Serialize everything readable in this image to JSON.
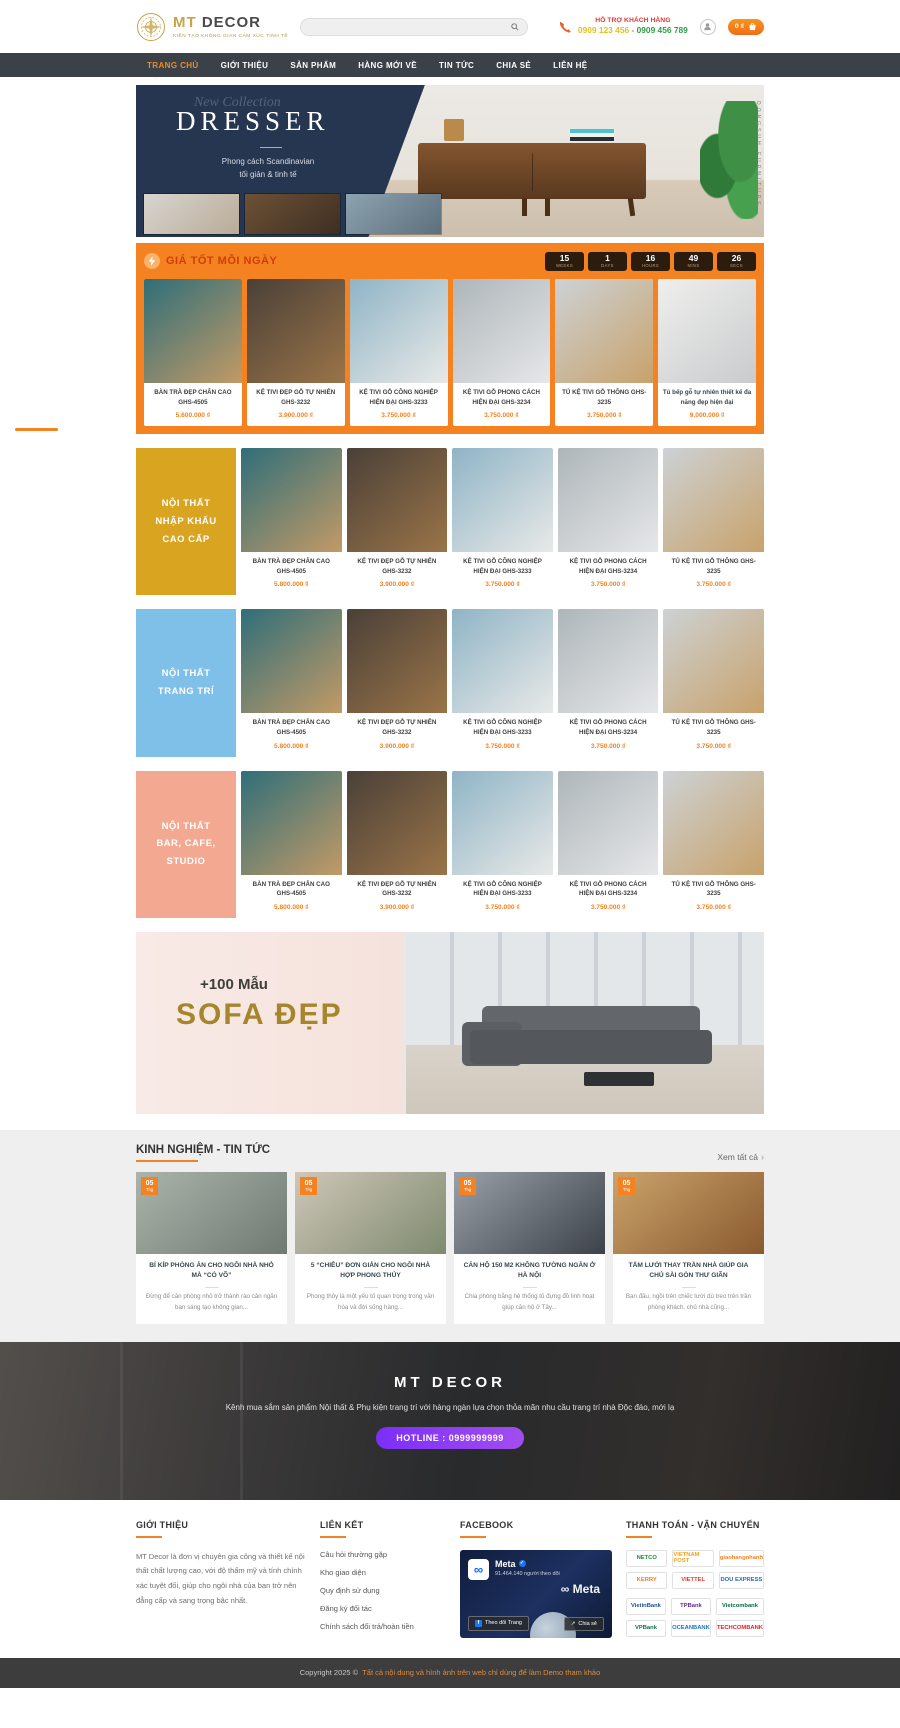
{
  "header": {
    "logo": {
      "brand_mt": "MT",
      "brand_decor": "DECOR",
      "tagline": "KIẾN TẠO KHÔNG GIAN CẢM XÚC TINH TẾ"
    },
    "search": {
      "placeholder": ""
    },
    "support": {
      "label": "HỖ TRỢ KHÁCH HÀNG",
      "phone1": "0909 123 456",
      "separator": "-",
      "phone2": "0909 456 789"
    },
    "cart": {
      "amount": "0 ₫"
    }
  },
  "nav": {
    "items": [
      {
        "label": "TRANG CHỦ",
        "active": true
      },
      {
        "label": "GIỚI THIỆU"
      },
      {
        "label": "SẢN PHẨM"
      },
      {
        "label": "HÀNG MỚI VỀ"
      },
      {
        "label": "TIN TỨC"
      },
      {
        "label": "CHIA SẺ"
      },
      {
        "label": "LIÊN HỆ"
      }
    ]
  },
  "hero": {
    "collection": "New Collection",
    "title": "DRESSER",
    "subtitle1": "Phong cách Scandinavian",
    "subtitle2": "tối giản & tinh tế",
    "vertical_text": "DONGSUH FURNITURE",
    "thumbs": [
      {
        "img": [
          "#d8d5d0",
          "#b9ab97"
        ]
      },
      {
        "img": [
          "#6d5136",
          "#3e2f22"
        ]
      },
      {
        "img": [
          "#8da3b0",
          "#5d6f7c"
        ]
      }
    ]
  },
  "deal": {
    "title": "GIÁ TỐT MỖI NGÀY",
    "countdown": [
      {
        "value": "15",
        "label": "WEEKS"
      },
      {
        "value": "1",
        "label": "DAYS"
      },
      {
        "value": "16",
        "label": "HOURS"
      },
      {
        "value": "49",
        "label": "MINS"
      },
      {
        "value": "26",
        "label": "SECS"
      }
    ],
    "products": [
      {
        "name": "BÀN TRÀ ĐẸP CHÂN CAO GHS-4505",
        "price": "5.600.000 ₫",
        "img": [
          "#2f6e79",
          "#c29a66"
        ]
      },
      {
        "name": "KỆ TIVI ĐẸP GỖ TỰ NHIÊN GHS-3232",
        "price": "3.900.000 ₫",
        "img": [
          "#4a4038",
          "#9a7448"
        ]
      },
      {
        "name": "KỆ TIVI GỖ CÔNG NGHIỆP HIỆN ĐẠI GHS-3233",
        "price": "3.750.000 ₫",
        "img": [
          "#8fb4c6",
          "#e8e9e7"
        ]
      },
      {
        "name": "KỆ TIVI GỖ PHONG CÁCH HIỆN ĐẠI GHS-3234",
        "price": "3.750.000 ₫",
        "img": [
          "#aeb6ba",
          "#e6e7e9"
        ]
      },
      {
        "name": "TỦ KỆ TIVI GỖ THÔNG GHS-3235",
        "price": "3.750.000 ₫",
        "img": [
          "#cdd2d5",
          "#c8a26b"
        ]
      },
      {
        "name": "Tủ bếp gỗ tự nhiên thiết kế đa năng đẹp hiện đại",
        "price": "9.000.000 ₫",
        "img": [
          "#efefed",
          "#c9cbcd"
        ],
        "plain": true
      }
    ]
  },
  "catalog": [
    {
      "name": "BÀN TRÀ ĐẸP CHÂN CAO GHS-4505",
      "price": "5.800.000 ₫",
      "img": [
        "#2f6e79",
        "#c29a66"
      ]
    },
    {
      "name": "KỆ TIVI ĐẸP GỖ TỰ NHIÊN GHS-3232",
      "price": "3.900.000 ₫",
      "img": [
        "#4a4038",
        "#9a7448"
      ]
    },
    {
      "name": "KỆ TIVI GỖ CÔNG NGHIỆP HIỆN ĐẠI GHS-3233",
      "price": "3.750.000 ₫",
      "img": [
        "#8fb4c6",
        "#e8e9e7"
      ]
    },
    {
      "name": "KỆ TIVI GỖ PHONG CÁCH HIỆN ĐẠI GHS-3234",
      "price": "3.750.000 ₫",
      "img": [
        "#aeb6ba",
        "#e6e7e9"
      ]
    },
    {
      "name": "TỦ KỆ TIVI GỖ THÔNG GHS-3235",
      "price": "3.750.000 ₫",
      "img": [
        "#cdd2d5",
        "#c8a26b"
      ]
    }
  ],
  "categories": [
    {
      "title": "NỘI THẤT NHẬP KHẨU CAO CẤP",
      "lines": [
        "NỘI THẤT",
        "NHẬP KHẨU",
        "CAO CẤP"
      ],
      "color": "#d9a41f",
      "product_ids": [
        0,
        1,
        2,
        3,
        4
      ]
    },
    {
      "title": "NỘI THẤT TRANG TRÍ",
      "lines": [
        "NỘI THẤT",
        "TRANG TRÍ"
      ],
      "color": "#7fc0e8",
      "product_ids": [
        0,
        1,
        2,
        3,
        4
      ]
    },
    {
      "title": "NỘI THẤT BAR, CAFE, STUDIO",
      "lines": [
        "NỘI THẤT",
        "BAR, CAFE,",
        "STUDIO"
      ],
      "color": "#f2a891",
      "product_ids": [
        0,
        1,
        2,
        3,
        4
      ]
    }
  ],
  "sofa_banner": {
    "count": "+100 Mẫu",
    "title": "SOFA ĐẸP"
  },
  "news": {
    "title": "KINH NGHIỆM - TIN TỨC",
    "view_all": "Xem tất cả",
    "articles": [
      {
        "date_day": "05",
        "date_month": "Thg",
        "title": "BÍ KÍP PHÒNG ĂN CHO NGÔI NHÀ NHỎ MÀ “CÓ VÕ”",
        "excerpt": "Đừng để căn phòng nhỏ trở thành rào cản ngăn bạn sáng tạo không gian...",
        "img": [
          "#aab4ab",
          "#6f7a72"
        ]
      },
      {
        "date_day": "05",
        "date_month": "Thg",
        "title": "5 “CHIÊU” ĐƠN GIẢN CHO NGÔI NHÀ HỢP PHONG THỦY",
        "excerpt": "Phong thủy là một yếu tố quan trọng trong văn hóa và đời sống hàng...",
        "img": [
          "#cfc6b8",
          "#7e8b6f"
        ]
      },
      {
        "date_day": "05",
        "date_month": "Thg",
        "title": "CĂN HỘ 150 M2 KHÔNG TƯỜNG NGĂN Ở HÀ NỘI",
        "excerpt": "Chia phòng bằng hệ thống tủ đựng đồ linh hoạt giúp căn hộ ở Tây...",
        "img": [
          "#9aa0a8",
          "#3c4248"
        ]
      },
      {
        "date_day": "05",
        "date_month": "Thg",
        "title": "TẤM LƯỚI THAY TRẦN NHÀ GIÚP GIA CHỦ SÀI GÒN THƯ GIÃN",
        "excerpt": "Ban đầu, ngồi trên chiếc lưới dù treo trên trần phòng khách, chủ nhà cũng...",
        "img": [
          "#caa36b",
          "#8a5a2e"
        ]
      }
    ]
  },
  "brand_banner": {
    "title": "MT DECOR",
    "description": "Kênh mua sắm sản phẩm Nội thất & Phụ kiện trang trí với hàng ngàn lựa chọn thỏa mãn nhu cầu trang trí nhà Độc đáo, mới lạ",
    "hotline": "HOTLINE : 0999999999"
  },
  "footer": {
    "about": {
      "heading": "GIỚI THIỆU",
      "text": "MT Decor là đơn vị chuyên gia công và thiết kế nội thất chất lượng cao, với độ thẩm mỹ và tính chính xác tuyệt đối, giúp cho ngôi nhà của bạn trở nên đẳng cấp và sang trọng bậc nhất."
    },
    "links": {
      "heading": "LIÊN KẾT",
      "items": [
        {
          "label": "Câu hỏi thường gặp"
        },
        {
          "label": "Kho giao diện"
        },
        {
          "label": "Quy định sử dụng"
        },
        {
          "label": "Đăng ký đối tác"
        },
        {
          "label": "Chính sách đổi trả/hoàn tiền"
        }
      ]
    },
    "facebook": {
      "heading": "FACEBOOK",
      "page_name": "Meta",
      "followers": "91.464.140 người theo dõi",
      "watermark": "∞ Meta",
      "follow_btn": "Theo dõi Trang",
      "share_btn": "Chia sẻ"
    },
    "payment": {
      "heading": "THANH TOÁN - VẬN CHUYỂN",
      "shipping": [
        {
          "name": "NETCO",
          "color": "#1e8f3e"
        },
        {
          "name": "VIETNAM POST",
          "color": "#f6a21c"
        },
        {
          "name": "giaohangnhanh",
          "color": "#f58220"
        },
        {
          "name": "KERRY",
          "color": "#f47b20"
        },
        {
          "name": "VIETTEL",
          "color": "#e03c31"
        },
        {
          "name": "DOU EXPRESS",
          "color": "#2b6cb0"
        }
      ],
      "banks": [
        {
          "name": "VietinBank",
          "color": "#1d4f91"
        },
        {
          "name": "TPBank",
          "color": "#5c2d91"
        },
        {
          "name": "Vietcombank",
          "color": "#00703c"
        },
        {
          "name": "VPBank",
          "color": "#0c713d"
        },
        {
          "name": "OCEANBANK",
          "color": "#1b75bb"
        },
        {
          "name": "TECHCOMBANK",
          "color": "#e31e26"
        }
      ]
    }
  },
  "copyright": {
    "prefix": "Copyright 2025 ©",
    "text": "Tất cả nội dung và hình ảnh trên web chỉ dùng để làm Demo tham khảo"
  },
  "colors": {
    "accent_orange": "#f58220",
    "nav_dark": "#3a4149",
    "hero_navy": "#263550",
    "hotline_purple": "#7b2ff7"
  }
}
